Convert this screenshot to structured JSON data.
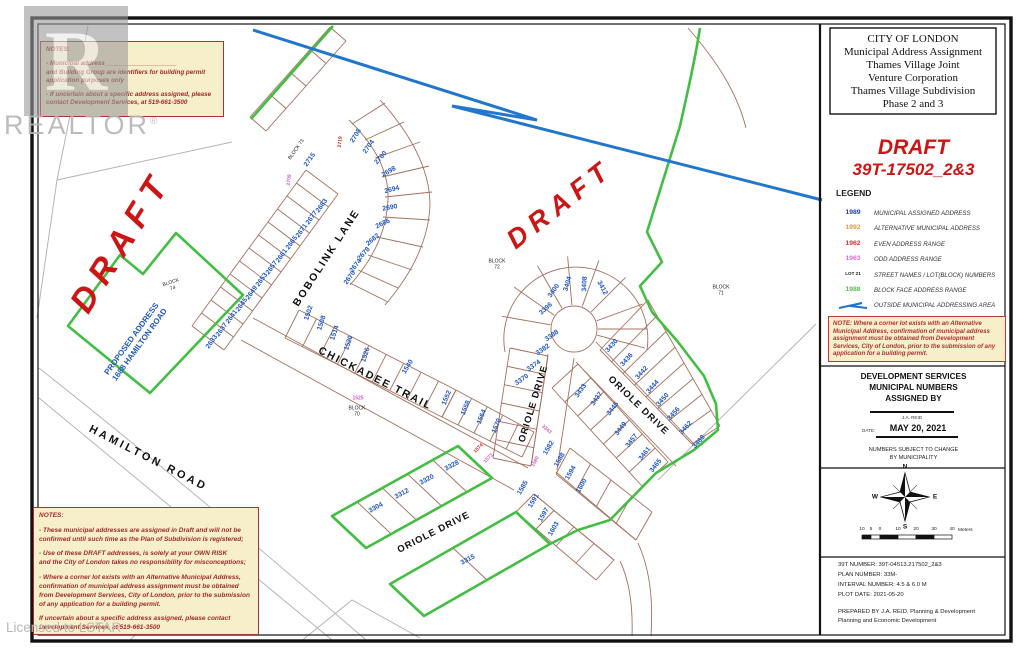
{
  "watermark": {
    "logo_letter": "R",
    "brand": "REALTOR",
    "reg": "®",
    "license": "Licensed to LSTAR"
  },
  "panel": {
    "title_lines": [
      "CITY OF LONDON",
      "Municipal Address Assignment",
      "Thames Village Joint",
      "Venture Corporation",
      "Thames Village Subdivision",
      "Phase 2 and 3"
    ],
    "draft_title": "DRAFT",
    "draft_number": "39T-17502_2&3",
    "legend_heading": "LEGEND",
    "legend_items": [
      {
        "sample": "1989",
        "color": "#1a3fae",
        "label": "MUNICIPAL ASSIGNED ADDRESS"
      },
      {
        "sample": "1992",
        "color": "#e09a3c",
        "label": "ALTERNATIVE MUNICIPAL ADDRESS"
      },
      {
        "sample": "1962",
        "color": "#cc3333",
        "label": "EVEN ADDRESS RANGE"
      },
      {
        "sample": "1963",
        "color": "#d66fd6",
        "label": "ODD ADDRESS RANGE"
      },
      {
        "sample": "LOT 21",
        "color": "#222222",
        "small": true,
        "label": "STREET NAMES / LOT(BLOCK) NUMBERS"
      },
      {
        "sample": "1988",
        "color": "#55bb55",
        "label": "BLOCK FACE ADDRESS RANGE"
      },
      {
        "sample": "",
        "zigzag": true,
        "color": "#1f74d0",
        "label": "OUTSIDE MUNICIPAL ADDRESSING AREA"
      }
    ],
    "note_text": "NOTE:  Where a corner lot exists with an Alternative Municipal Address, confirmation of municipal address assignment must be obtained from Development Services, City of London, prior to the submission of any application for a building permit.",
    "assigned_lines": [
      "DEVELOPMENT SERVICES",
      "MUNICIPAL NUMBERS",
      "ASSIGNED BY"
    ],
    "signature_name": "J.A. REID",
    "date_label": "DATE:",
    "date_value": "MAY 20, 2021",
    "subject_line1": "NUMBERS SUBJECT TO CHANGE",
    "subject_line2": "BY MUNICIPALITY",
    "compass": {
      "n": "N",
      "e": "E",
      "s": "S",
      "w": "W"
    },
    "scale_ticks": [
      "10",
      "5",
      "0",
      "10",
      "20",
      "30",
      "40"
    ],
    "scale_unit": "Meters",
    "info_lines": [
      "39T NUMBER:  39T-04513.217502_2&3",
      "PLAN NUMBER:  33M-",
      "INTERVAL NUMBER:   4.5 & 6.0 M",
      "PLOT DATE:   2021-05-20"
    ],
    "prepared_lines": [
      "PREPARED BY J.A. REID, Planning & Development",
      "Planning and Economic Development"
    ]
  },
  "notes_top": {
    "title": "NOTES:",
    "lines": [
      "",
      "- Municipal address ____________________",
      "and Building Group are identifiers for building permit",
      "application purposes only",
      "",
      "- If uncertain about a specific address assigned, please",
      "contact Development Services, at 519-661-3500"
    ]
  },
  "notes_bottom": {
    "title": "NOTES:",
    "lines": [
      "",
      "- These municipal addresses are assigned in Draft and will not be",
      "confirmed until such time as the Plan of Subdivision is registered;",
      "",
      "- Use of these DRAFT addresses, is solely at your OWN RISK",
      "and the City of London takes no responsibility for misconceptions;",
      "",
      "- Where a corner lot exists with an Alternative Municipal Address,",
      "confirmation of municipal address assignment must be obtained",
      "from Development Services, City of London, prior to the submission",
      "of any application for a building permit.",
      "",
      "If uncertain about a specific address assigned, please contact",
      "Development Services, at 519-661-3500"
    ]
  },
  "map": {
    "colors": {
      "municipal": "#1f57c4",
      "odd": "#c95fc9",
      "even": "#cc2a2a",
      "green": "#44bd44",
      "lotline": "#a4705e",
      "outside": "#2277cc"
    },
    "draft_marks": [
      {
        "text": "DRAFT",
        "x": 122,
        "y": 242,
        "rot": -58,
        "size": 34,
        "ls": 9
      },
      {
        "text": "DRAFT",
        "x": 560,
        "y": 204,
        "rot": -38,
        "size": 27,
        "ls": 7
      }
    ],
    "street_labels": [
      {
        "text": "BOBOLINK  LANE",
        "x": 327,
        "y": 258,
        "rot": -57,
        "size": 10.5,
        "ls": 2
      },
      {
        "text": "CHICKADEE  TRAIL",
        "x": 375,
        "y": 379,
        "rot": 27,
        "size": 10.5,
        "ls": 2
      },
      {
        "text": "ORIOLE  DRIVE",
        "x": 534,
        "y": 404,
        "rot": -73,
        "size": 9.5,
        "ls": 1
      },
      {
        "text": "ORIOLE  DRIVE",
        "x": 638,
        "y": 406,
        "rot": 44,
        "size": 9.5,
        "ls": 1
      },
      {
        "text": "ORIOLE  DRIVE",
        "x": 434,
        "y": 533,
        "rot": -27,
        "size": 9.5,
        "ls": 1
      },
      {
        "text": "HAMILTON   ROAD",
        "x": 148,
        "y": 459,
        "rot": 27,
        "size": 11,
        "ls": 3
      }
    ],
    "block_labels": [
      {
        "text": "BLOCK  73",
        "x": 297,
        "y": 150,
        "rot": -55
      },
      {
        "text": "BLOCK\n74",
        "x": 172,
        "y": 286,
        "rot": -18
      },
      {
        "text": "BLOCK\n72",
        "x": 497,
        "y": 265,
        "rot": 0
      },
      {
        "text": "BLOCK\n71",
        "x": 721,
        "y": 291,
        "rot": 0
      },
      {
        "text": "BLOCK\n70",
        "x": 357,
        "y": 412,
        "rot": 0
      }
    ],
    "proposed": {
      "line1": "PROPOSED ADDRESS",
      "line2": "1688  HAMILTON  ROAD",
      "x": 136,
      "y": 342,
      "rot": -54
    },
    "addresses": [
      {
        "t": "2715",
        "x": 310,
        "y": 160,
        "r": -55,
        "c": "b"
      },
      {
        "t": "2719",
        "x": 341,
        "y": 142,
        "r": -85,
        "c": "r",
        "s": 5
      },
      {
        "t": "2709",
        "x": 290,
        "y": 180,
        "r": -85,
        "c": "m",
        "s": 5
      },
      {
        "t": "2683",
        "x": 322,
        "y": 206,
        "r": -54,
        "c": "b"
      },
      {
        "t": "2677",
        "x": 312,
        "y": 218,
        "r": -54,
        "c": "b"
      },
      {
        "t": "2671",
        "x": 302,
        "y": 231,
        "r": -54,
        "c": "b"
      },
      {
        "t": "2665",
        "x": 292,
        "y": 243,
        "r": -54,
        "c": "b"
      },
      {
        "t": "2661",
        "x": 282,
        "y": 256,
        "r": -54,
        "c": "b"
      },
      {
        "t": "2657",
        "x": 272,
        "y": 268,
        "r": -54,
        "c": "b"
      },
      {
        "t": "2653",
        "x": 262,
        "y": 280,
        "r": -54,
        "c": "b"
      },
      {
        "t": "2649",
        "x": 252,
        "y": 293,
        "r": -54,
        "c": "b"
      },
      {
        "t": "2645",
        "x": 242,
        "y": 305,
        "r": -54,
        "c": "b"
      },
      {
        "t": "2641",
        "x": 232,
        "y": 317,
        "r": -54,
        "c": "b"
      },
      {
        "t": "2637",
        "x": 222,
        "y": 330,
        "r": -54,
        "c": "b"
      },
      {
        "t": "2633",
        "x": 212,
        "y": 342,
        "r": -54,
        "c": "b"
      },
      {
        "t": "2708",
        "x": 356,
        "y": 136,
        "r": -58,
        "c": "b"
      },
      {
        "t": "2704",
        "x": 369,
        "y": 147,
        "r": -55,
        "c": "b"
      },
      {
        "t": "2700",
        "x": 381,
        "y": 158,
        "r": -48,
        "c": "b"
      },
      {
        "t": "2698",
        "x": 389,
        "y": 172,
        "r": -30,
        "c": "b"
      },
      {
        "t": "2694",
        "x": 392,
        "y": 190,
        "r": -14,
        "c": "b"
      },
      {
        "t": "2690",
        "x": 390,
        "y": 208,
        "r": -10,
        "c": "b"
      },
      {
        "t": "2686",
        "x": 383,
        "y": 224,
        "r": -25,
        "c": "b"
      },
      {
        "t": "2682",
        "x": 373,
        "y": 240,
        "r": -40,
        "c": "b"
      },
      {
        "t": "2678",
        "x": 364,
        "y": 254,
        "r": -48,
        "c": "b"
      },
      {
        "t": "2674",
        "x": 356,
        "y": 266,
        "r": -52,
        "c": "b"
      },
      {
        "t": "2670",
        "x": 350,
        "y": 278,
        "r": -55,
        "c": "b"
      },
      {
        "t": "1502",
        "x": 309,
        "y": 313,
        "r": -72,
        "c": "b"
      },
      {
        "t": "1508",
        "x": 322,
        "y": 323,
        "r": -72,
        "c": "b"
      },
      {
        "t": "1514",
        "x": 335,
        "y": 333,
        "r": -72,
        "c": "b"
      },
      {
        "t": "1520",
        "x": 349,
        "y": 343,
        "r": -72,
        "c": "b"
      },
      {
        "t": "1526",
        "x": 366,
        "y": 355,
        "r": -72,
        "c": "b"
      },
      {
        "t": "1540",
        "x": 408,
        "y": 367,
        "r": -58,
        "c": "b"
      },
      {
        "t": "1552",
        "x": 447,
        "y": 398,
        "r": -68,
        "c": "b"
      },
      {
        "t": "1558",
        "x": 466,
        "y": 408,
        "r": -68,
        "c": "b"
      },
      {
        "t": "1564",
        "x": 482,
        "y": 417,
        "r": -68,
        "c": "b"
      },
      {
        "t": "1570",
        "x": 497,
        "y": 426,
        "r": -68,
        "c": "b"
      },
      {
        "t": "1525",
        "x": 358,
        "y": 399,
        "r": 0,
        "c": "m",
        "s": 5
      },
      {
        "t": "3370",
        "x": 522,
        "y": 380,
        "r": -35,
        "c": "b"
      },
      {
        "t": "3374",
        "x": 534,
        "y": 366,
        "r": -35,
        "c": "b"
      },
      {
        "t": "3382",
        "x": 543,
        "y": 350,
        "r": -35,
        "c": "b"
      },
      {
        "t": "3388",
        "x": 552,
        "y": 336,
        "r": -35,
        "c": "b"
      },
      {
        "t": "3396",
        "x": 546,
        "y": 309,
        "r": -42,
        "c": "b"
      },
      {
        "t": "3400",
        "x": 554,
        "y": 291,
        "r": -55,
        "c": "b"
      },
      {
        "t": "3404",
        "x": 568,
        "y": 284,
        "r": -74,
        "c": "b"
      },
      {
        "t": "3408",
        "x": 585,
        "y": 284,
        "r": -88,
        "c": "b"
      },
      {
        "t": "3412",
        "x": 602,
        "y": 288,
        "r": 62,
        "c": "b"
      },
      {
        "t": "3430",
        "x": 612,
        "y": 346,
        "r": -48,
        "c": "b"
      },
      {
        "t": "3436",
        "x": 627,
        "y": 360,
        "r": -48,
        "c": "b"
      },
      {
        "t": "3442",
        "x": 642,
        "y": 373,
        "r": -48,
        "c": "b"
      },
      {
        "t": "3444",
        "x": 653,
        "y": 387,
        "r": -48,
        "c": "b"
      },
      {
        "t": "3450",
        "x": 663,
        "y": 400,
        "r": -48,
        "c": "b"
      },
      {
        "t": "3456",
        "x": 674,
        "y": 414,
        "r": -48,
        "c": "b"
      },
      {
        "t": "3462",
        "x": 686,
        "y": 428,
        "r": -48,
        "c": "b"
      },
      {
        "t": "3468",
        "x": 699,
        "y": 442,
        "r": -48,
        "c": "b"
      },
      {
        "t": "3433",
        "x": 581,
        "y": 391,
        "r": -55,
        "c": "b"
      },
      {
        "t": "3437",
        "x": 597,
        "y": 399,
        "r": -55,
        "c": "b"
      },
      {
        "t": "3445",
        "x": 613,
        "y": 409,
        "r": -52,
        "c": "b"
      },
      {
        "t": "3449",
        "x": 621,
        "y": 429,
        "r": -52,
        "c": "b"
      },
      {
        "t": "3457",
        "x": 632,
        "y": 441,
        "r": -52,
        "c": "b"
      },
      {
        "t": "3461",
        "x": 645,
        "y": 454,
        "r": -52,
        "c": "b"
      },
      {
        "t": "3465",
        "x": 656,
        "y": 466,
        "r": -52,
        "c": "b"
      },
      {
        "t": "3343",
        "x": 546,
        "y": 430,
        "r": 42,
        "c": "m",
        "s": 5
      },
      {
        "t": "1573",
        "x": 489,
        "y": 459,
        "r": -45,
        "c": "m",
        "s": 5
      },
      {
        "t": "1574",
        "x": 479,
        "y": 449,
        "r": -45,
        "c": "r",
        "s": 5
      },
      {
        "t": "1580",
        "x": 536,
        "y": 462,
        "r": -60,
        "c": "m",
        "s": 5
      },
      {
        "t": "1582",
        "x": 549,
        "y": 448,
        "r": -60,
        "c": "b"
      },
      {
        "t": "1588",
        "x": 560,
        "y": 460,
        "r": -60,
        "c": "b"
      },
      {
        "t": "1594",
        "x": 571,
        "y": 473,
        "r": -60,
        "c": "b"
      },
      {
        "t": "1600",
        "x": 582,
        "y": 486,
        "r": -60,
        "c": "b"
      },
      {
        "t": "1585",
        "x": 523,
        "y": 488,
        "r": -60,
        "c": "b"
      },
      {
        "t": "1591",
        "x": 534,
        "y": 501,
        "r": -60,
        "c": "b"
      },
      {
        "t": "1597",
        "x": 544,
        "y": 515,
        "r": -60,
        "c": "b"
      },
      {
        "t": "1603",
        "x": 554,
        "y": 529,
        "r": -60,
        "c": "b"
      },
      {
        "t": "3304",
        "x": 376,
        "y": 508,
        "r": -28,
        "c": "b"
      },
      {
        "t": "3312",
        "x": 402,
        "y": 494,
        "r": -28,
        "c": "b"
      },
      {
        "t": "3320",
        "x": 427,
        "y": 480,
        "r": -28,
        "c": "b"
      },
      {
        "t": "3328",
        "x": 452,
        "y": 466,
        "r": -28,
        "c": "b"
      },
      {
        "t": "3315",
        "x": 468,
        "y": 560,
        "r": -28,
        "c": "b"
      }
    ]
  }
}
